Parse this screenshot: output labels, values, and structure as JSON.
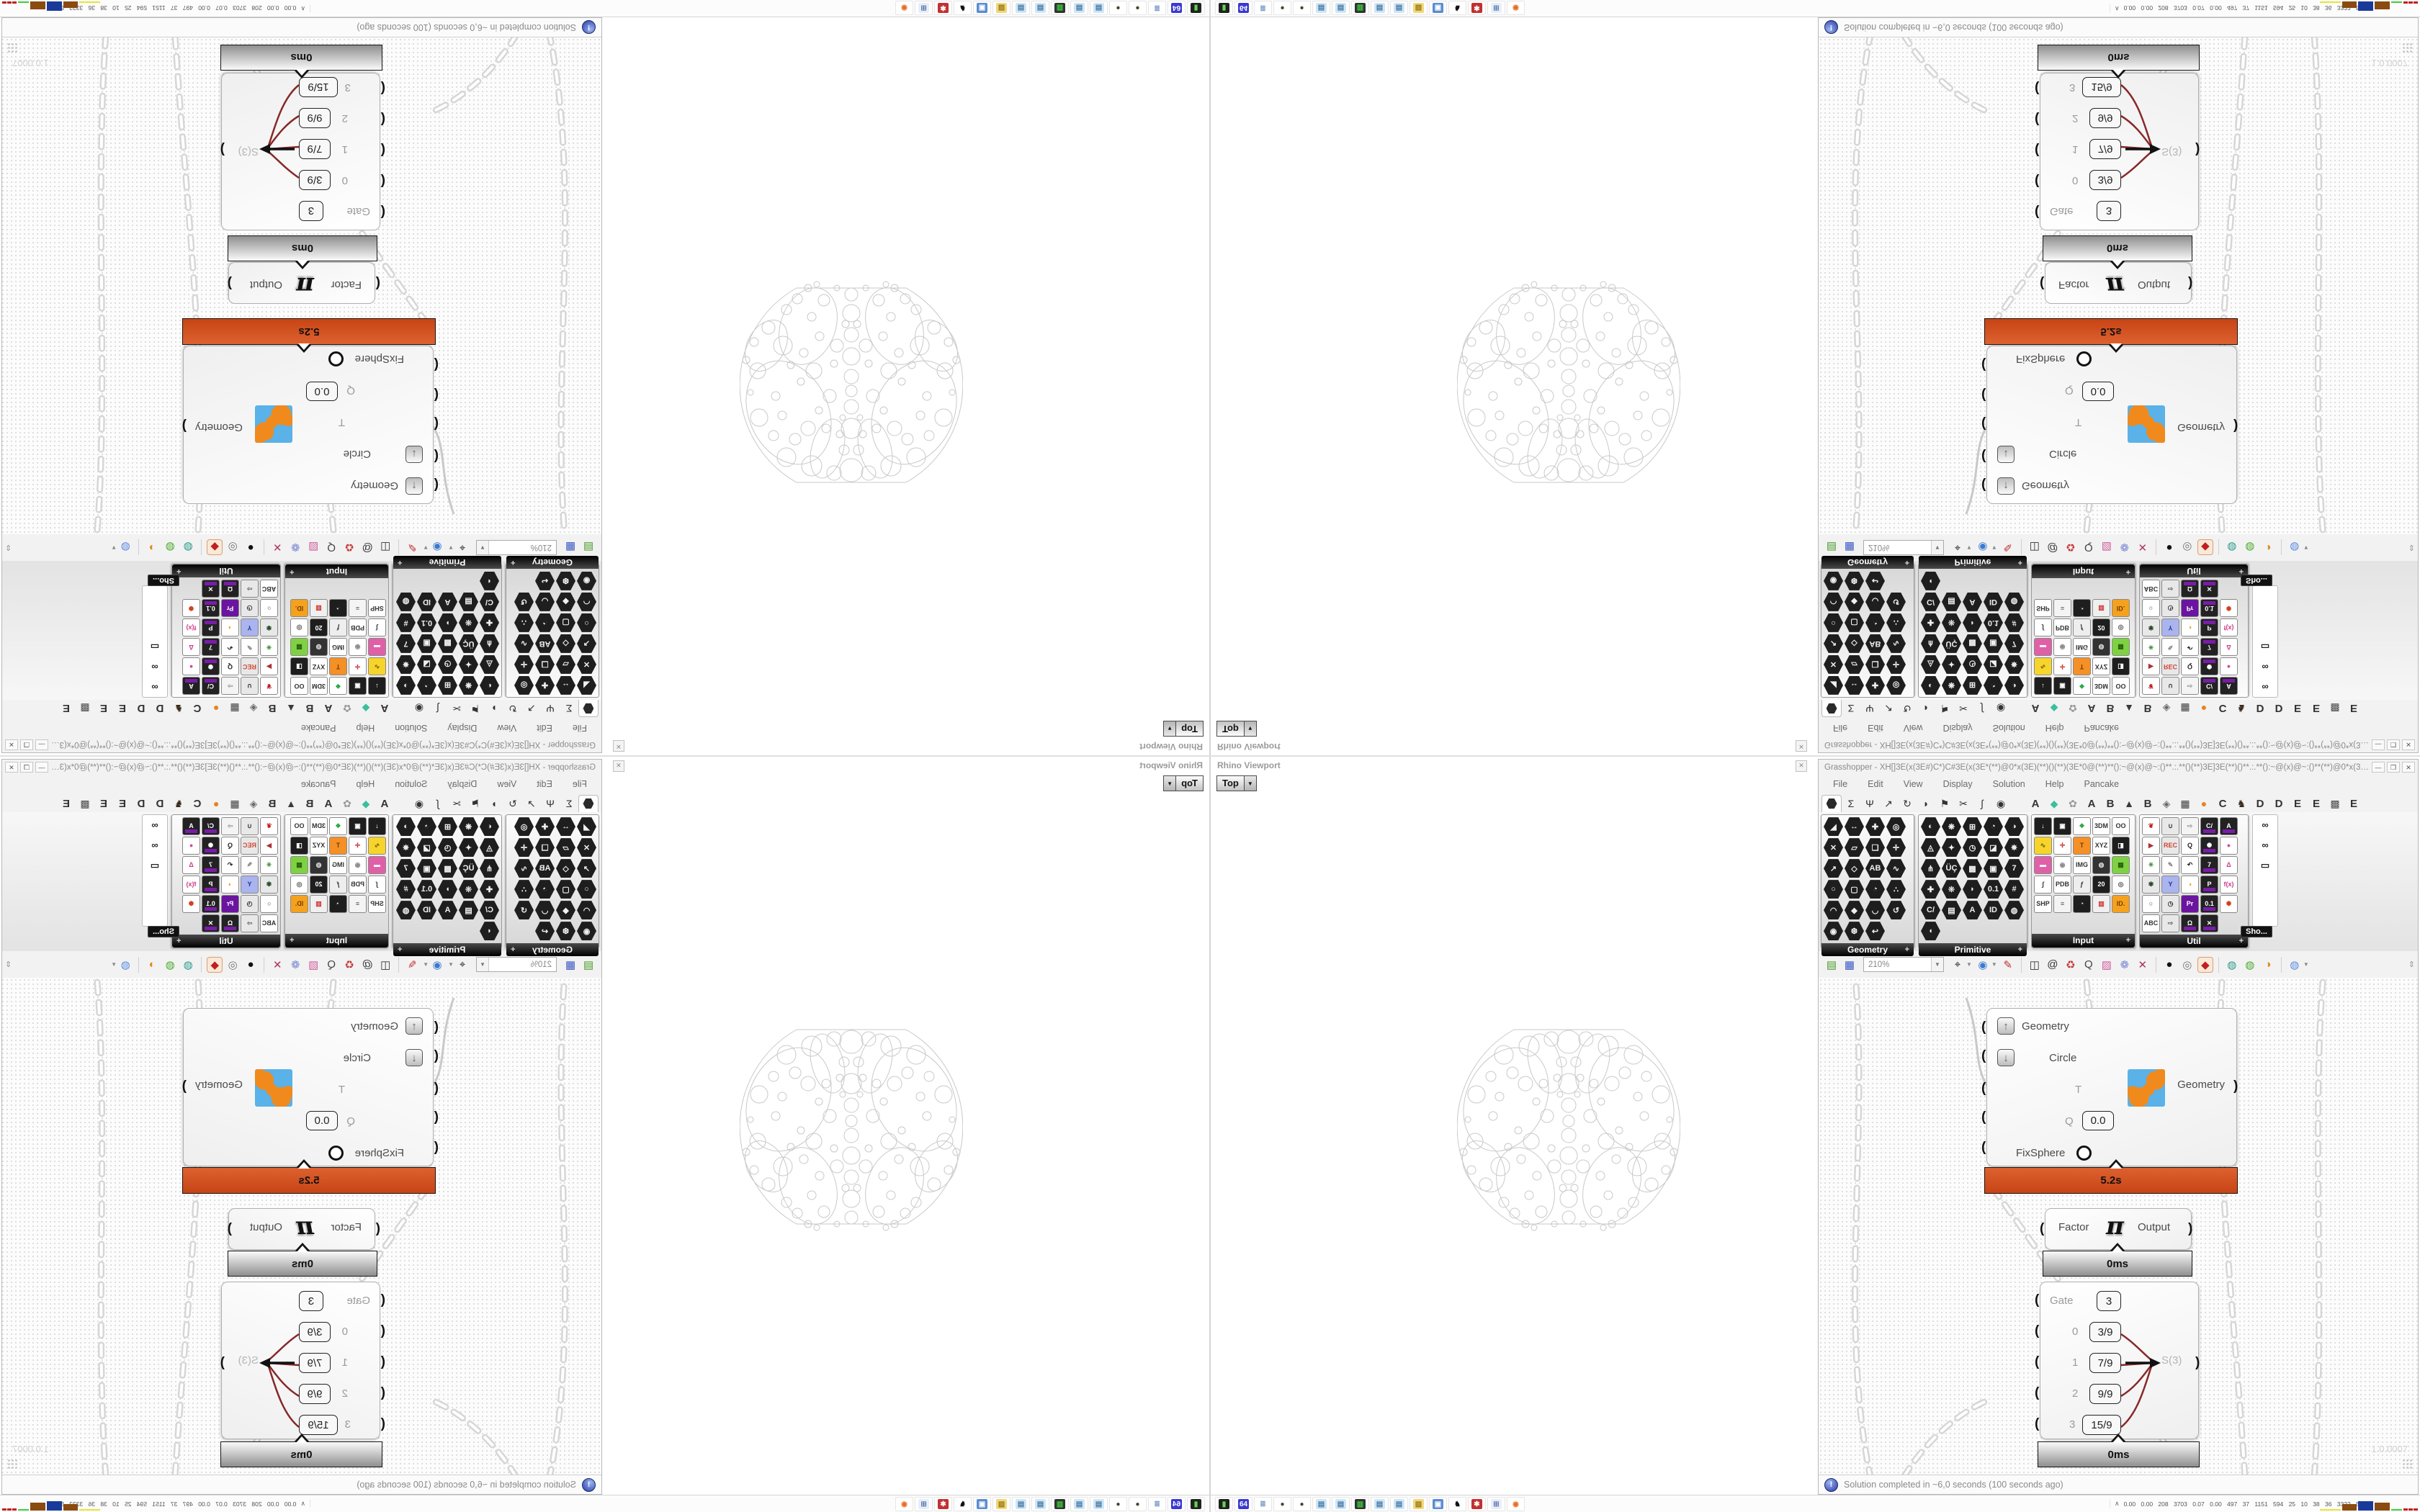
{
  "rhino_panel": {
    "title": "Rhino Viewport",
    "close_glyph": "✕",
    "viewport_tab": "Top",
    "tab_arrow": "▼"
  },
  "gh": {
    "title": "Grasshopper - XH[]3E(x(3E#)C*)C#3E(x(3E*(**)@0*x(3E)(**)()(**)(3E*0@(**)**():~@(x)@~:()**.:.**()(**)3E]3E(**)()**.:.**():~@(x)@~:()**(**)@0*x(3E)(**)()(**)...",
    "window_buttons": {
      "minimize": "—",
      "maximize": "❒",
      "close": "✕"
    },
    "menu": [
      "File",
      "Edit",
      "View",
      "Display",
      "Solution",
      "Help",
      "Pancake"
    ],
    "tabs": [
      {
        "n": "tab-params",
        "hex": true,
        "sel": true
      },
      {
        "n": "tab-maths",
        "g": "Σ"
      },
      {
        "n": "tab-sets",
        "g": "Ψ"
      },
      {
        "n": "tab-vector",
        "g": "↗"
      },
      {
        "n": "tab-curve",
        "g": "↻"
      },
      {
        "n": "tab-surface",
        "g": "◗"
      },
      {
        "n": "tab-mesh",
        "g": "⚑"
      },
      {
        "n": "tab-intersect",
        "g": "✂"
      },
      {
        "n": "tab-transform",
        "g": "∫"
      },
      {
        "n": "tab-display",
        "g": "◉"
      },
      {
        "sp": true
      },
      {
        "n": "tab-plugin-a1",
        "g": "A",
        "b": true
      },
      {
        "n": "tab-plugin-gem",
        "g": "◆",
        "c": "#3bbf9e"
      },
      {
        "n": "tab-plugin-flower",
        "g": "✿",
        "c": "#9a9a9a"
      },
      {
        "n": "tab-plugin-a2",
        "g": "A",
        "b": true
      },
      {
        "n": "tab-plugin-b1",
        "g": "B",
        "b": true
      },
      {
        "n": "tab-plugin-mountain",
        "g": "▲",
        "c": "#3a3a3a"
      },
      {
        "n": "tab-plugin-b2",
        "g": "B",
        "b": true
      },
      {
        "n": "tab-plugin-shield",
        "g": "◈",
        "c": "#6a6a6a"
      },
      {
        "n": "tab-plugin-grid",
        "g": "▦",
        "c": "#3a3a3a"
      },
      {
        "n": "tab-plugin-orange",
        "g": "●",
        "c": "#e8821e"
      },
      {
        "n": "tab-plugin-c",
        "g": "C",
        "b": true
      },
      {
        "n": "tab-plugin-bird",
        "g": "♞",
        "c": "#3a2a1a"
      },
      {
        "n": "tab-plugin-d1",
        "g": "D",
        "b": true
      },
      {
        "n": "tab-plugin-d2",
        "g": "D",
        "b": true
      },
      {
        "n": "tab-plugin-e1",
        "g": "E",
        "b": true
      },
      {
        "n": "tab-plugin-e2",
        "g": "E",
        "b": true
      },
      {
        "n": "tab-plugin-dots",
        "g": "▩",
        "c": "#4a4a4a"
      },
      {
        "n": "tab-plugin-e3",
        "g": "E",
        "b": true
      }
    ],
    "palettes": [
      {
        "label": "Geometry",
        "width": 130,
        "icons": [
          [
            "◢"
          ],
          [
            "↔"
          ],
          [
            "✚"
          ],
          [
            "◎"
          ],
          [
            "✕"
          ],
          [
            "▱"
          ],
          [
            "❏"
          ],
          [
            "✛"
          ],
          [
            "↗"
          ],
          [
            "◇"
          ],
          [
            "AB"
          ],
          [
            "∿"
          ],
          [
            "○"
          ],
          [
            "▢"
          ],
          [
            "◔"
          ],
          [
            "∴"
          ],
          [
            "◠"
          ],
          [
            "◆"
          ],
          [
            "◡"
          ],
          [
            "↺"
          ],
          [
            "◉"
          ],
          [
            "❆"
          ],
          [
            "↩"
          ]
        ]
      },
      {
        "label": "Primitive",
        "width": 152,
        "icons": [
          [
            "◐"
          ],
          [
            "❋"
          ],
          [
            "⊞"
          ],
          [
            "◔"
          ],
          [
            "◑"
          ],
          [
            "◬"
          ],
          [
            "✦"
          ],
          [
            "◷"
          ],
          [
            "◪"
          ],
          [
            "✵"
          ],
          [
            "⋔"
          ],
          [
            "ÜÇ"
          ],
          [
            "▩"
          ],
          [
            "▣"
          ],
          [
            "7"
          ],
          [
            "✚"
          ],
          [
            "❊"
          ],
          [
            "◗"
          ],
          [
            "0.1"
          ],
          [
            "#"
          ],
          [
            "C/"
          ],
          [
            "▤"
          ],
          [
            "A"
          ],
          [
            "ID"
          ],
          [
            "◍"
          ],
          [
            "◖"
          ]
        ]
      },
      {
        "label": "Input",
        "width": 145,
        "square": true,
        "icons": [
          [
            "↓",
            "#1e1e1e",
            "#fff"
          ],
          [
            "▣",
            "#1e1e1e",
            "#fff"
          ],
          [
            "❖",
            "#fff",
            "#2aa84a"
          ],
          [
            "3DM",
            "#fff",
            "#333"
          ],
          [
            "OO",
            "#fff",
            "#333"
          ],
          [
            "∿",
            "#f6d42c",
            "#6a5200"
          ],
          [
            "✛",
            "#fff",
            "#c33"
          ],
          [
            "T",
            "#f49026",
            "#7a3c00"
          ],
          [
            "XYZ",
            "#fff",
            "#333"
          ],
          [
            "◨",
            "#1e1e1e",
            "#fff"
          ],
          [
            "▬",
            "#e060a8",
            "#fff"
          ],
          [
            "◉",
            "#fff",
            "#888"
          ],
          [
            "IMG",
            "#fff",
            "#333"
          ],
          [
            "◍",
            "#333",
            "#ddd"
          ],
          [
            "▦",
            "#7ed242",
            "#2c5e10"
          ],
          [
            "∫",
            "#fff",
            "#333"
          ],
          [
            "PDB",
            "#fff",
            "#333"
          ],
          [
            "ƒ",
            "#eee",
            "#333"
          ],
          [
            "20",
            "#1e1e1e",
            "#fff"
          ],
          [
            "◎",
            "#fff",
            "#555"
          ],
          [
            "SHP",
            "#fff",
            "#333"
          ],
          [
            "≡",
            "#f4f4f4",
            "#555"
          ],
          [
            "◔",
            "#1e1e1e",
            "#fff"
          ],
          [
            "▥",
            "#f0f0f0",
            "#d03030"
          ],
          [
            "ID.",
            "#f4a21e",
            "#7a3c00"
          ]
        ]
      },
      {
        "label": "Util",
        "width": 152,
        "square": true,
        "icons": [
          [
            "❦",
            "#fff",
            "#c01818"
          ],
          [
            "∪",
            "#e8e8e8",
            "#333"
          ],
          [
            "⇨",
            "#f4f4f4",
            "#999"
          ],
          [
            "C/",
            "#222",
            "#fff",
            "p"
          ],
          [
            "A",
            "#222",
            "#fff",
            "p"
          ],
          [
            "▶",
            "#fff",
            "#b03030"
          ],
          [
            "REC",
            "#e8e8e8",
            "#c43"
          ],
          [
            "Q",
            "#fff",
            "#222"
          ],
          [
            "✺",
            "#222",
            "#fff",
            "p"
          ],
          [
            "●",
            "#fff",
            "#cc4a9a"
          ],
          [
            "✳",
            "#fff",
            "#3a8a3a"
          ],
          [
            "✎",
            "#fff",
            "#888"
          ],
          [
            "↶",
            "#fff",
            "#222"
          ],
          [
            "7",
            "#222",
            "#fff",
            "p"
          ],
          [
            "Δ",
            "#fff",
            "#cc3a8a"
          ],
          [
            "✾",
            "#e8e8e8",
            "#2a4a2a"
          ],
          [
            "Y",
            "#aab4ee",
            "#223a8a"
          ],
          [
            "◑",
            "#fff",
            "#e8a020"
          ],
          [
            "P",
            "#222",
            "#fff",
            "p"
          ],
          [
            "f(x)",
            "#fff",
            "#cc3a8a"
          ],
          [
            "○",
            "#fff",
            "#333"
          ],
          [
            "◷",
            "#e8e8e8",
            "#333"
          ],
          [
            "Pr",
            "#6a14a0",
            "#fff"
          ],
          [
            "0.1",
            "#222",
            "#fff",
            "p"
          ],
          [
            "✺",
            "#fff",
            "#d04020"
          ],
          [
            "ABC",
            "#fff",
            "#333"
          ],
          [
            "⇨",
            "#e8e8e8",
            "#666"
          ],
          [
            "Ω",
            "#222",
            "#fff",
            "p"
          ],
          [
            "✕",
            "#222",
            "#fff",
            "p"
          ]
        ]
      }
    ],
    "overflow": {
      "tooltip": "Sho...",
      "icons": [
        "∞",
        "∞",
        "▭"
      ]
    },
    "toolbar": {
      "zoom": "210%",
      "icons": [
        {
          "n": "open-document-icon",
          "g": "▤",
          "c": "#4a9a2a"
        },
        {
          "n": "save-document-icon",
          "g": "▦",
          "c": "#3a56c4"
        },
        {
          "zoom": true
        },
        {
          "n": "zoom-extents-icon",
          "g": "⌖",
          "c": "#222"
        },
        {
          "dd": true
        },
        {
          "n": "preview-eye-icon",
          "g": "◉",
          "c": "#3a7ad0"
        },
        {
          "dd": true
        },
        {
          "n": "sketch-pen-icon",
          "g": "✎",
          "c": "#c03030"
        },
        {
          "sep": true
        },
        {
          "n": "camera-icon",
          "g": "◫",
          "c": "#333"
        },
        {
          "n": "remote-at-icon",
          "g": "@",
          "c": "#333"
        },
        {
          "n": "gha-cycle-icon",
          "g": "♻",
          "c": "#c43a3a"
        },
        {
          "n": "examine-icon",
          "g": "Q",
          "c": "#444"
        },
        {
          "n": "cluster-box-icon",
          "g": "▨",
          "c": "#d060a0"
        },
        {
          "n": "galapagos-balloon-icon",
          "g": "❁",
          "c": "#7a8ad0"
        },
        {
          "n": "crossref-icon",
          "g": "✕",
          "c": "#b03060"
        },
        {
          "sep": true
        },
        {
          "n": "preview-off-icon",
          "g": "●",
          "c": "#111"
        },
        {
          "n": "preview-wire-icon",
          "g": "◎",
          "c": "#777"
        },
        {
          "n": "preview-shaded-icon",
          "g": "◆",
          "c": "#c02020",
          "sel": true
        },
        {
          "sep": true
        },
        {
          "n": "group-teal-icon",
          "g": "◍",
          "c": "#2a9a8a"
        },
        {
          "n": "group-green-icon",
          "g": "◍",
          "c": "#4aaa2a"
        },
        {
          "n": "group-orange-icon",
          "g": "◑",
          "c": "#e08a20"
        },
        {
          "sep": true
        },
        {
          "n": "group-blue-icon",
          "g": "◍",
          "c": "#5a8ae0"
        },
        {
          "dd": true
        }
      ],
      "scroll_glyph": "⇕"
    },
    "canvas": {
      "cluster": {
        "inputs": [
          {
            "label": "Geometry",
            "widget": "up"
          },
          {
            "label": "Circle",
            "widget": "down"
          },
          {
            "label": "T"
          },
          {
            "label": "Q",
            "value": "0.0"
          },
          {
            "label": "FixSphere",
            "widget": "toggle"
          }
        ],
        "output": "Geometry",
        "profiler": "5.2s"
      },
      "pi": {
        "input": "Factor",
        "glyph": "π",
        "output": "Output",
        "profiler": "0ms"
      },
      "gate": {
        "rows": [
          {
            "label": "Gate",
            "value": "3"
          },
          {
            "label": "0",
            "value": "3/9"
          },
          {
            "label": "1",
            "value": "7/9"
          },
          {
            "label": "2",
            "value": "9/9"
          },
          {
            "label": "3",
            "value": "15/9"
          }
        ],
        "output": "S(3)",
        "profiler": "0ms"
      },
      "version": "1.0.0007"
    },
    "status": "Solution completed in ~6,0 seconds (100 seconds ago)"
  },
  "taskbar": {
    "expand_glyph": "∧",
    "stats": "0.00 0.00 208 3703 0.07 0.00 497 37 1151 594 25 10 38 36 3322 5106",
    "icons": [
      {
        "n": "drive-icon",
        "g": "▮",
        "fg": "#6ad05a",
        "bg": "#1c241c"
      },
      {
        "n": "floppy64-icon",
        "g": "64",
        "fg": "#fff",
        "bg": "#3a3ad0"
      },
      {
        "n": "scroll-icon",
        "g": "≣",
        "fg": "#7a9cc6",
        "bg": "#fff"
      },
      {
        "n": "knot-icon",
        "g": "●",
        "fg": "#4a432a",
        "bg": "#fff"
      },
      {
        "n": "knot-icon",
        "g": "●",
        "fg": "#4a432a",
        "bg": "#fff"
      },
      {
        "n": "notepad-icon",
        "g": "▤",
        "fg": "#4a7aa8",
        "bg": "#cfe6f5"
      },
      {
        "n": "notepad-icon",
        "g": "▤",
        "fg": "#4a7aa8",
        "bg": "#cfe6f5"
      },
      {
        "n": "perf-monitor-icon",
        "g": "▥",
        "fg": "#3ad03a",
        "bg": "#333"
      },
      {
        "n": "notepad-icon",
        "g": "▤",
        "fg": "#4a7aa8",
        "bg": "#cfe6f5"
      },
      {
        "n": "notepad-icon",
        "g": "▤",
        "fg": "#4a7aa8",
        "bg": "#cfe6f5"
      },
      {
        "n": "folder-icon",
        "g": "▨",
        "fg": "#9a7a1a",
        "bg": "#f0d87a"
      },
      {
        "n": "display-settings-icon",
        "g": "▣",
        "fg": "#fff",
        "bg": "#5a8cd0"
      },
      {
        "n": "cat-icon",
        "g": "♞",
        "fg": "#111",
        "bg": "#fff"
      },
      {
        "n": "red-gear-icon",
        "g": "✱",
        "fg": "#fff",
        "bg": "#c23030"
      },
      {
        "n": "calculator-icon",
        "g": "⊞",
        "fg": "#5a7ab0",
        "bg": "#e8eef8"
      },
      {
        "n": "firefox-icon",
        "g": "◉",
        "fg": "#e86a1e",
        "bg": "#fff"
      }
    ],
    "monitor_blocks": [
      {
        "t": "line",
        "c": "#e8e23a",
        "w": 38
      },
      {
        "t": "bar",
        "c": "#8a4a10",
        "w": 26,
        "h": 9
      },
      {
        "t": "bar",
        "c": "#1a3a9a",
        "w": 28,
        "h": 13
      },
      {
        "t": "bar",
        "c": "#8a4a10",
        "w": 28,
        "h": 11
      },
      {
        "t": "line",
        "c": "#3ad03a",
        "w": 20
      },
      {
        "t": "zig",
        "c": "#c02020",
        "w": 26
      }
    ]
  }
}
